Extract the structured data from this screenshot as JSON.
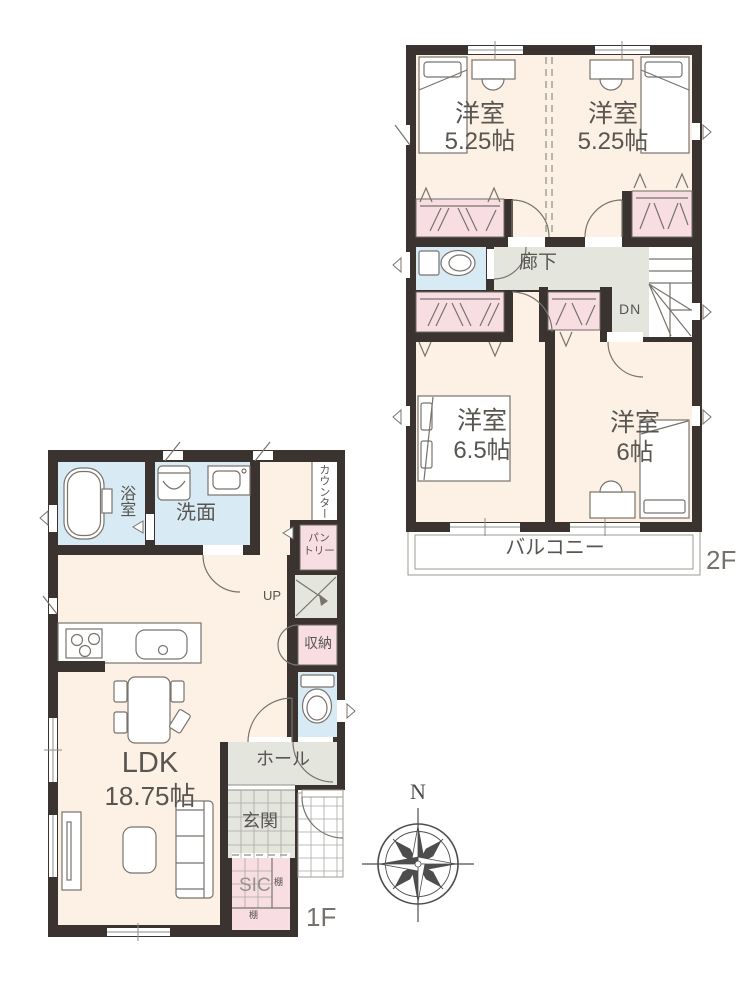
{
  "colors": {
    "wall": "#3a3330",
    "cream": "#fcf1e4",
    "pink": "#f8dee3",
    "blue": "#d8ebf5",
    "gray": "#e4e5dc",
    "line": "#6f6a64",
    "furn": "#78736d",
    "text": "#595551",
    "muted": "#76716d",
    "grid": "#a9a9a2"
  },
  "floor2": {
    "label": "2F",
    "rooms": {
      "room_a": {
        "name": "洋室",
        "size": "5.25帖"
      },
      "room_b": {
        "name": "洋室",
        "size": "5.25帖"
      },
      "room_c": {
        "name": "洋室",
        "size": "6.5帖"
      },
      "room_d": {
        "name": "洋室",
        "size": "6帖"
      },
      "hallway": "廊下",
      "stairs": "DN",
      "balcony": "バルコニー"
    }
  },
  "floor1": {
    "label": "1F",
    "rooms": {
      "ldk": {
        "name": "LDK",
        "size": "18.75帖"
      },
      "bath": "浴室",
      "washroom": "洗面",
      "counter": "カウンター",
      "pantry_line1": "パン",
      "pantry_line2": "トリー",
      "stairs": "UP",
      "storage": "収納",
      "hall": "ホール",
      "entrance": "玄関",
      "shoe_closet": "SIC",
      "shelf_right": "棚",
      "shelf_bottom": "棚"
    }
  },
  "compass": {
    "north": "N"
  }
}
